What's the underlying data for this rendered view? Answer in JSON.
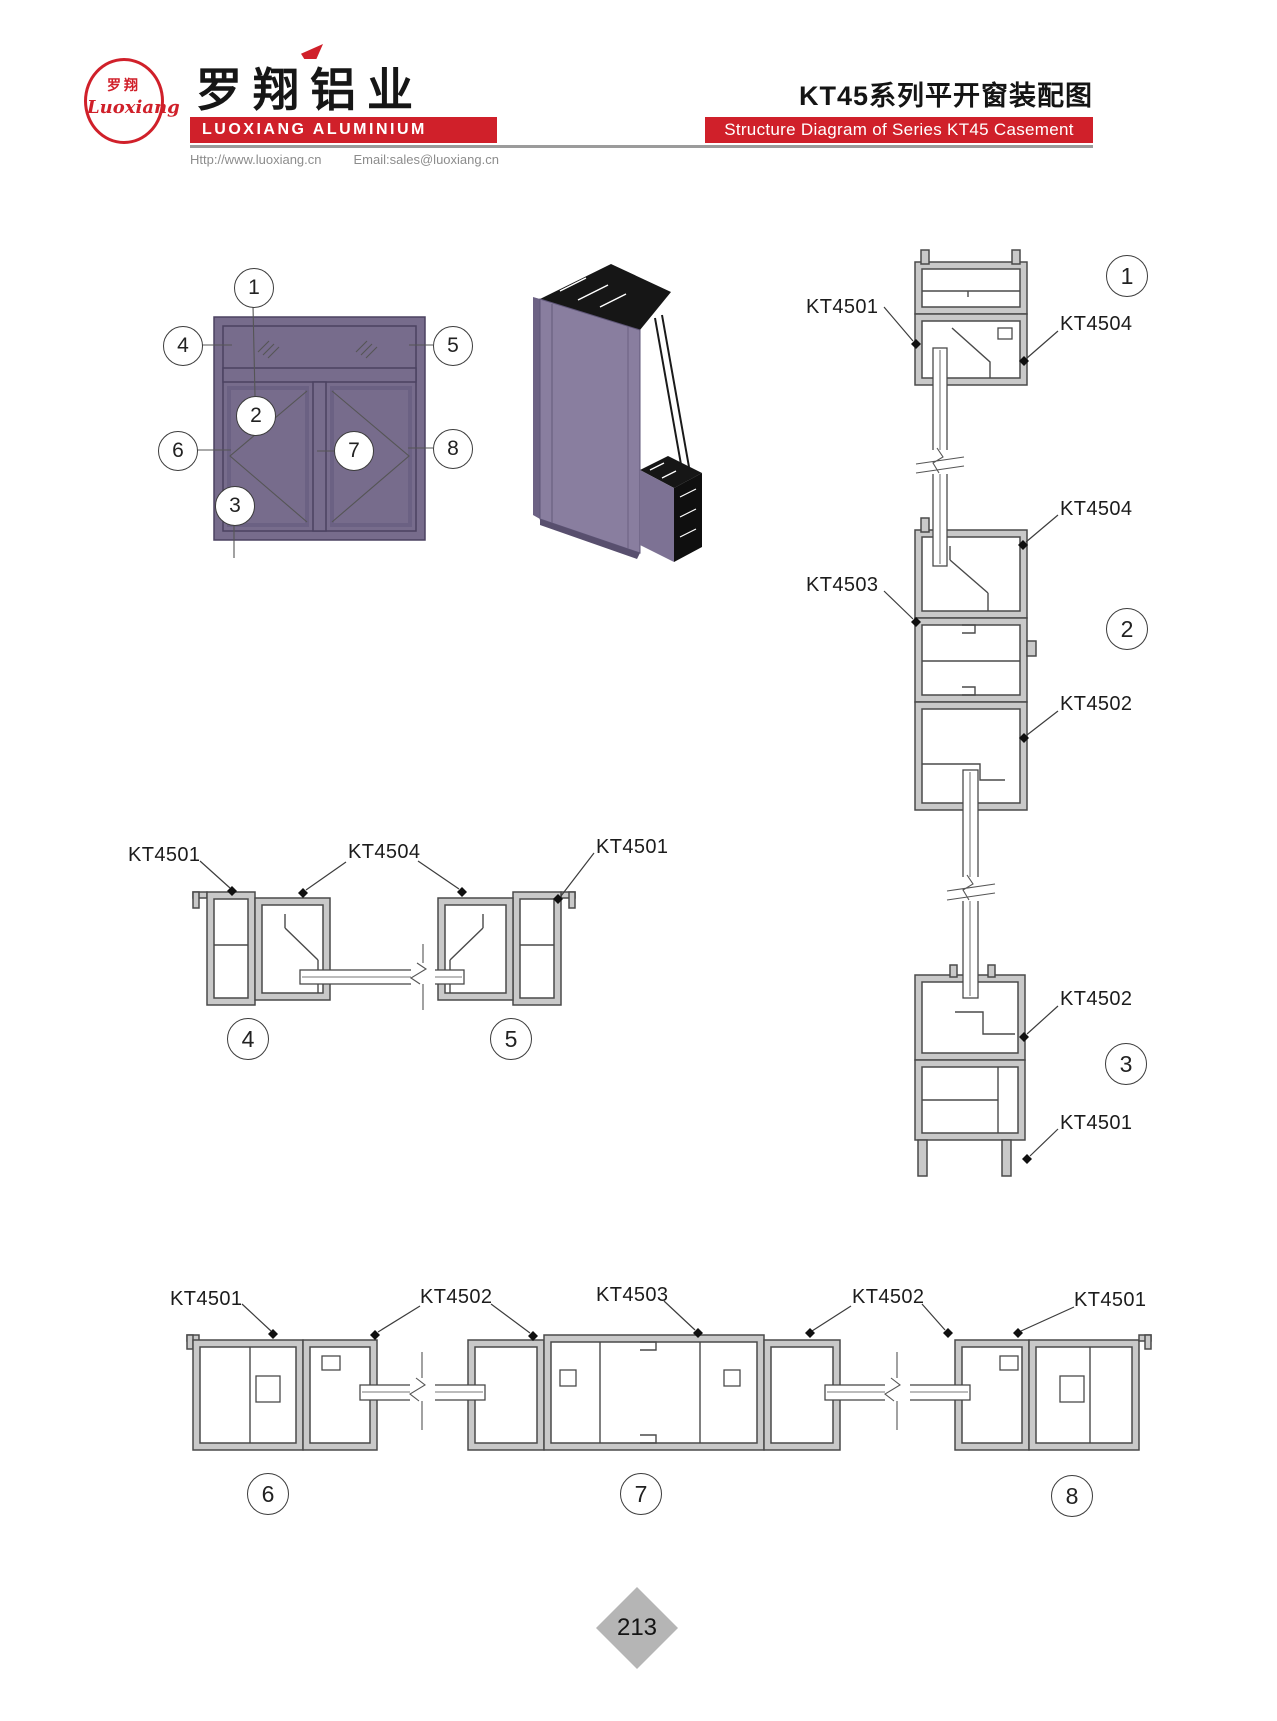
{
  "colors": {
    "accent_red": "#d0202a",
    "frame_purple": "#776c8c",
    "profile_gray": "#c9c9c9",
    "page_diamond_gray": "#b5b5b5"
  },
  "header": {
    "logo_zh": "罗翔",
    "logo_script": "Luoxiang",
    "brand_zh": "罗翔铝业",
    "brand_en": "LUOXIANG ALUMINIUM",
    "website": "Http://www.luoxiang.cn",
    "email": "Email:sales@luoxiang.cn",
    "title_zh": "KT45系列平开窗装配图",
    "title_en": "Structure Diagram of Series KT45 Casement Window"
  },
  "window_callouts": {
    "c1": "1",
    "c2": "2",
    "c3": "3",
    "c4": "4",
    "c5": "5",
    "c6": "6",
    "c7": "7",
    "c8": "8"
  },
  "section_circles": {
    "s1": "1",
    "s2": "2",
    "s3": "3",
    "s4": "4",
    "s5": "5",
    "s6": "6",
    "s7": "7",
    "s8": "8"
  },
  "profile_labels": {
    "sec1_left": "KT4501",
    "sec1_right": "KT4504",
    "sec2_top_right": "KT4504",
    "sec2_left": "KT4503",
    "sec2_bottom_right": "KT4502",
    "sec3_top_right": "KT4502",
    "sec3_bottom_right": "KT4501",
    "mid_left": "KT4501",
    "mid_center": "KT4504",
    "mid_right": "KT4501",
    "bottom_left_frame": "KT4501",
    "bottom_left_sash": "KT4502",
    "bottom_mullion": "KT4503",
    "bottom_right_sash": "KT4502",
    "bottom_right_frame": "KT4501"
  },
  "footer": {
    "page_number": "213"
  }
}
